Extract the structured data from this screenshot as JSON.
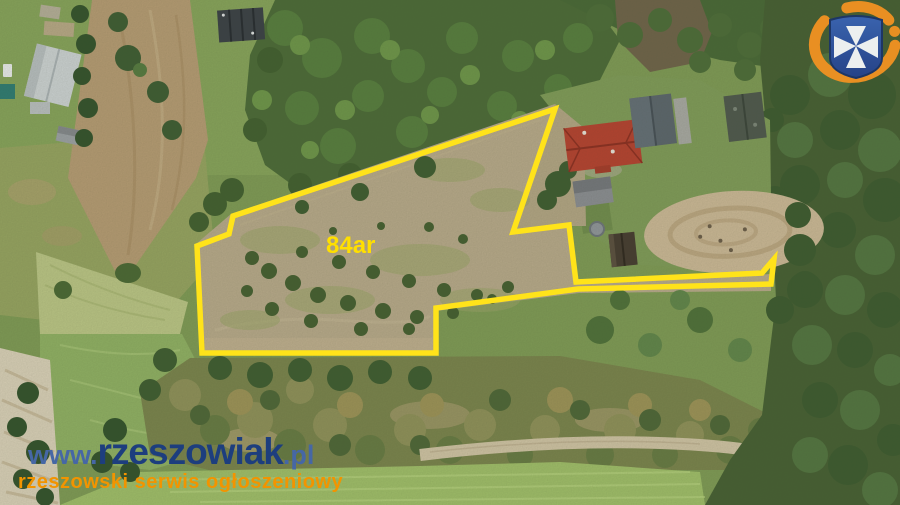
{
  "overlay": {
    "area_label": "84ar",
    "outline_color": "#ffe31a",
    "label_color": "#ffdf00"
  },
  "watermark": {
    "prefix": "www.",
    "brand": "rzeszowiak",
    "tld": ".pl",
    "tagline": "rzeszowski serwis ogłoszeniowy",
    "brand_color": "#1d3e7e",
    "prefix_color": "#4667a5",
    "tagline_color": "#f29400"
  },
  "logo": {
    "icon": "rzeszow-crest-icon",
    "shield_color": "#2c50a2",
    "cross_color": "#f5f7fa",
    "ring_color": "#f29222"
  }
}
